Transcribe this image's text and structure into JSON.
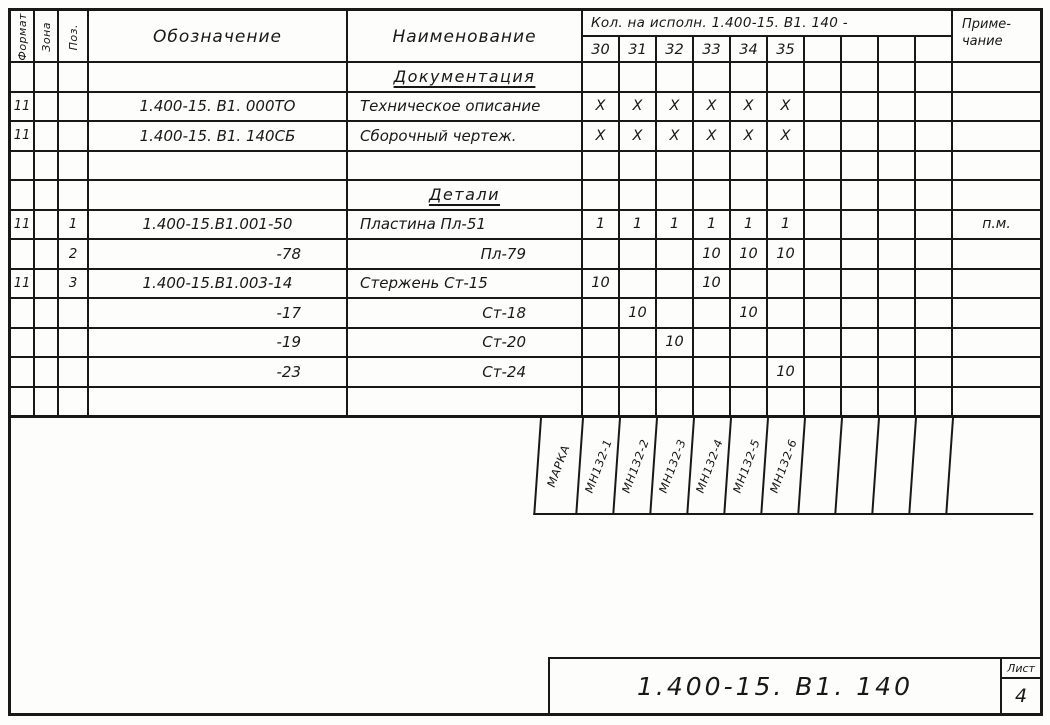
{
  "sheet": {
    "doc_number": "1.400-15. В1. 140",
    "list_label": "Лист",
    "list_number": "4"
  },
  "table": {
    "headers": {
      "format": "Формат",
      "zone": "Зона",
      "pos": "Поз.",
      "designation": "Обозначение",
      "name": "Наименование",
      "qty_group": "Кол. на исполн. 1.400-15. В1. 140 -",
      "qty_cols": [
        "30",
        "31",
        "32",
        "33",
        "34",
        "35",
        "",
        "",
        "",
        ""
      ],
      "note": "Приме-\nчание"
    },
    "rows": [
      {
        "type": "section",
        "name": "Документация"
      },
      {
        "type": "item",
        "format": "11",
        "designation": "1.400-15. В1. 000ТО",
        "name": "Техническое описание",
        "qty": [
          "X",
          "X",
          "X",
          "X",
          "X",
          "X",
          "",
          "",
          "",
          ""
        ]
      },
      {
        "type": "item",
        "format": "11",
        "designation": "1.400-15. В1. 140СБ",
        "name": "Сборочный чертеж.",
        "qty": [
          "X",
          "X",
          "X",
          "X",
          "X",
          "X",
          "",
          "",
          "",
          ""
        ]
      },
      {
        "type": "empty"
      },
      {
        "type": "section",
        "name": "Детали"
      },
      {
        "type": "item",
        "format": "11",
        "pos": "1",
        "designation": "1.400-15.В1.001-50",
        "name": "Пластина Пл-51",
        "qty": [
          "1",
          "1",
          "1",
          "1",
          "1",
          "1",
          "",
          "",
          "",
          ""
        ],
        "note": "п.м."
      },
      {
        "type": "item",
        "pos": "2",
        "cont": true,
        "designation": "-78",
        "name": "Пл-79",
        "qty": [
          "",
          "",
          "",
          "10",
          "10",
          "10",
          "",
          "",
          "",
          ""
        ]
      },
      {
        "type": "item",
        "format": "11",
        "pos": "3",
        "designation": "1.400-15.В1.003-14",
        "name": "Стержень Ст-15",
        "qty": [
          "10",
          "",
          "",
          "10",
          "",
          "",
          "",
          "",
          "",
          ""
        ]
      },
      {
        "type": "item",
        "cont": true,
        "designation": "-17",
        "name": "Ст-18",
        "qty": [
          "",
          "10",
          "",
          "",
          "10",
          "",
          "",
          "",
          "",
          ""
        ]
      },
      {
        "type": "item",
        "cont": true,
        "designation": "-19",
        "name": "Ст-20",
        "qty": [
          "",
          "",
          "10",
          "",
          "",
          "",
          "",
          "",
          "",
          ""
        ]
      },
      {
        "type": "item",
        "cont": true,
        "designation": "-23",
        "name": "Ст-24",
        "qty": [
          "",
          "",
          "",
          "",
          "",
          "10",
          "",
          "",
          "",
          ""
        ]
      },
      {
        "type": "empty"
      }
    ]
  },
  "marka": {
    "label": "МАРКА",
    "cells": [
      "МН132-1",
      "МН132-2",
      "МН132-3",
      "МН132-4",
      "МН132-5",
      "МН132-6",
      "",
      "",
      "",
      ""
    ]
  }
}
